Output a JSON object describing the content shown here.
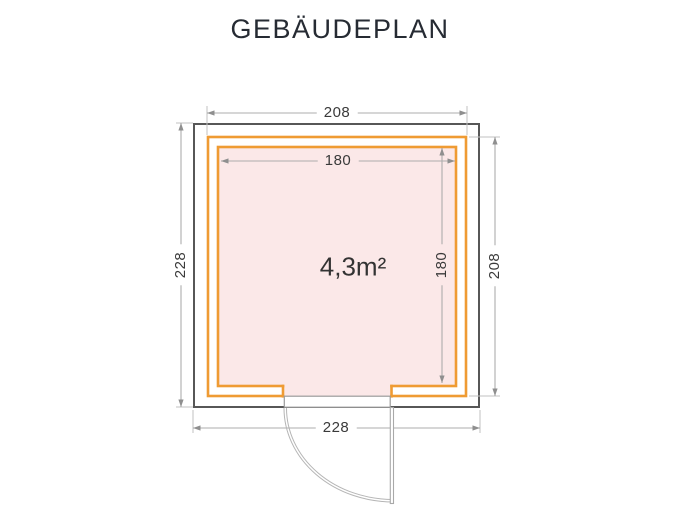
{
  "title": "GEBÄUDEPLAN",
  "plan": {
    "area_label": "4,3m²",
    "dimensions": {
      "top_width": "208",
      "inner_width": "180",
      "left_height": "228",
      "inner_height": "180",
      "right_height": "208",
      "bottom_width": "228"
    },
    "colors": {
      "wall_outline": "#575757",
      "insulation_orange": "#EF9B33",
      "floor_pink": "#FBE8E8",
      "dimension_line_gray": "#ACACAC",
      "dimension_text": "#3A3A3A",
      "title_text": "#262B33"
    }
  }
}
